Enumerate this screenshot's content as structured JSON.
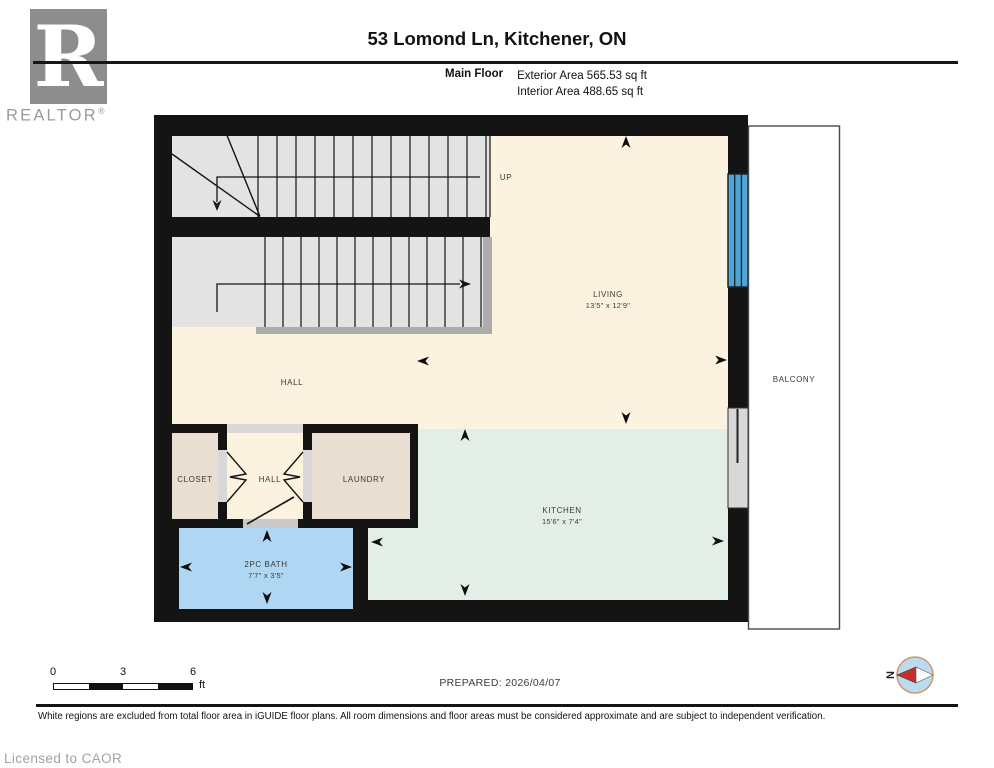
{
  "header": {
    "logo": {
      "letter": "R",
      "brand": "REALTOR",
      "registered": "®"
    },
    "title": "53 Lomond Ln, Kitchener, ON",
    "floor": "Main Floor",
    "exterior_area": "Exterior Area 565.53 sq ft",
    "interior_area": "Interior Area 488.65 sq ft"
  },
  "plan": {
    "stairs_label": "UP",
    "rooms": {
      "living": {
        "label": "LIVING",
        "dims": "13'5\" x 12'9\""
      },
      "kitchen": {
        "label": "KITCHEN",
        "dims": "15'6\" x 7'4\""
      },
      "hall_main": {
        "label": "HALL"
      },
      "hall_entry": {
        "label": "HALL"
      },
      "closet": {
        "label": "CLOSET"
      },
      "laundry": {
        "label": "LAUNDRY"
      },
      "bath": {
        "label": "2PC BATH",
        "dims": "7'7\" x 3'5\""
      },
      "balcony": {
        "label": "BALCONY"
      }
    }
  },
  "footer": {
    "scale": {
      "ticks": [
        "0",
        "3",
        "6"
      ],
      "unit": "ft"
    },
    "prepared": "PREPARED: 2026/04/07",
    "compass_label": "N",
    "disclaimer": "White regions are excluded from total floor area in iGUIDE floor plans. All room dimensions and floor areas must be considered approximate and are subject to independent verification.",
    "license": "Licensed to CAOR"
  },
  "colors": {
    "wall": "#141414",
    "floor_cream": "#FBF3DF",
    "floor_green": "#E3EEE6",
    "floor_blue": "#AFD6F2",
    "floor_tan": "#E9DED2",
    "stairs_gray": "#E3E3E3",
    "opening_gray": "#D8D8D8",
    "window_blue": "#4FA4D8",
    "compass_fill": "#BDDBEF",
    "compass_red": "#C62F28",
    "logo_gray": "#8D8D8D"
  }
}
